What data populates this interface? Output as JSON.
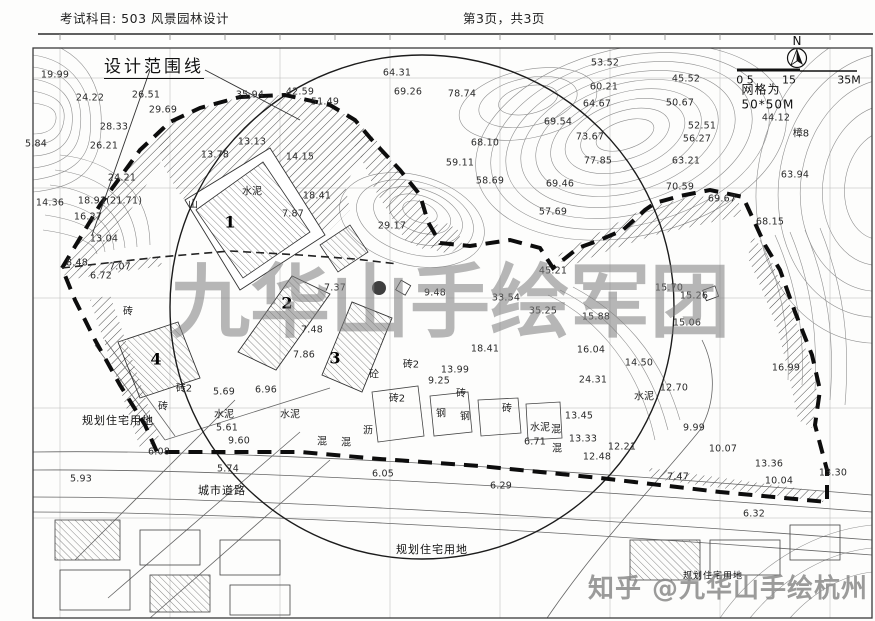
{
  "header": {
    "subject": "考试科目: 503 风景园林设计",
    "page_info": "第3页，共3页"
  },
  "map": {
    "boundary_label": "设计范围线",
    "compass": {
      "label": "N"
    },
    "scale": {
      "tick_left": "0 5",
      "tick_mid": "15",
      "tick_right": "35M",
      "grid_note": "网格为50*50M"
    },
    "building_numbers": [
      {
        "t": "1",
        "x": 230,
        "y": 222
      },
      {
        "t": "2",
        "x": 287,
        "y": 303
      },
      {
        "t": "3",
        "x": 335,
        "y": 358
      },
      {
        "t": "4",
        "x": 156,
        "y": 359
      }
    ],
    "zone_labels": [
      {
        "t": "规划住宅用地",
        "x": 118,
        "y": 420
      },
      {
        "t": "规划住宅用地",
        "x": 432,
        "y": 549
      },
      {
        "t": "规划住宅用地",
        "x": 713,
        "y": 575,
        "fs": 9
      },
      {
        "t": "城市道路",
        "x": 222,
        "y": 490
      }
    ],
    "material_labels": [
      {
        "t": "水泥",
        "x": 252,
        "y": 190
      },
      {
        "t": "山",
        "x": 193,
        "y": 203
      },
      {
        "t": "水泥",
        "x": 224,
        "y": 413
      },
      {
        "t": "水泥",
        "x": 290,
        "y": 413
      },
      {
        "t": "水泥",
        "x": 540,
        "y": 426
      },
      {
        "t": "水泥",
        "x": 644,
        "y": 395
      },
      {
        "t": "砖",
        "x": 128,
        "y": 310
      },
      {
        "t": "砖2",
        "x": 184,
        "y": 387
      },
      {
        "t": "砖",
        "x": 163,
        "y": 405
      },
      {
        "t": "砖2",
        "x": 411,
        "y": 363
      },
      {
        "t": "砖2",
        "x": 397,
        "y": 397
      },
      {
        "t": "砖",
        "x": 461,
        "y": 392
      },
      {
        "t": "砖",
        "x": 507,
        "y": 407
      },
      {
        "t": "砼",
        "x": 374,
        "y": 373
      },
      {
        "t": "钢",
        "x": 441,
        "y": 412
      },
      {
        "t": "钢",
        "x": 465,
        "y": 415
      },
      {
        "t": "混",
        "x": 556,
        "y": 428
      },
      {
        "t": "混",
        "x": 557,
        "y": 447
      },
      {
        "t": "混",
        "x": 322,
        "y": 440
      },
      {
        "t": "混",
        "x": 346,
        "y": 441
      },
      {
        "t": "沥",
        "x": 368,
        "y": 429
      },
      {
        "t": "樟8",
        "x": 801,
        "y": 132
      }
    ],
    "elevations": [
      {
        "t": "19.99",
        "x": 55,
        "y": 75
      },
      {
        "t": "24.22",
        "x": 90,
        "y": 98
      },
      {
        "t": "26.51",
        "x": 146,
        "y": 95
      },
      {
        "t": "28.33",
        "x": 114,
        "y": 127
      },
      {
        "t": "29.69",
        "x": 163,
        "y": 110
      },
      {
        "t": "26.21",
        "x": 104,
        "y": 146
      },
      {
        "t": "35.94",
        "x": 250,
        "y": 95
      },
      {
        "t": "5.84",
        "x": 36,
        "y": 144
      },
      {
        "t": "24.21",
        "x": 122,
        "y": 178
      },
      {
        "t": "18.91(21.71)",
        "x": 110,
        "y": 201
      },
      {
        "t": "14.36",
        "x": 50,
        "y": 203
      },
      {
        "t": "16.27",
        "x": 88,
        "y": 217
      },
      {
        "t": "13.04",
        "x": 104,
        "y": 239
      },
      {
        "t": "8.48",
        "x": 77,
        "y": 263
      },
      {
        "t": "7.07",
        "x": 120,
        "y": 267
      },
      {
        "t": "6.72",
        "x": 101,
        "y": 276
      },
      {
        "t": "13.78",
        "x": 215,
        "y": 155
      },
      {
        "t": "13.13",
        "x": 252,
        "y": 142
      },
      {
        "t": "14.15",
        "x": 300,
        "y": 157
      },
      {
        "t": "18.41",
        "x": 317,
        "y": 196
      },
      {
        "t": "7.87",
        "x": 293,
        "y": 214
      },
      {
        "t": "29.17",
        "x": 392,
        "y": 226
      },
      {
        "t": "42.59",
        "x": 300,
        "y": 92
      },
      {
        "t": "51.49",
        "x": 325,
        "y": 102
      },
      {
        "t": "64.31",
        "x": 397,
        "y": 73
      },
      {
        "t": "69.26",
        "x": 408,
        "y": 92
      },
      {
        "t": "78.74",
        "x": 462,
        "y": 94
      },
      {
        "t": "68.10",
        "x": 485,
        "y": 143
      },
      {
        "t": "59.11",
        "x": 460,
        "y": 163
      },
      {
        "t": "58.69",
        "x": 490,
        "y": 181
      },
      {
        "t": "53.52",
        "x": 605,
        "y": 63
      },
      {
        "t": "60.21",
        "x": 604,
        "y": 87
      },
      {
        "t": "64.67",
        "x": 597,
        "y": 104
      },
      {
        "t": "69.54",
        "x": 558,
        "y": 122
      },
      {
        "t": "73.67",
        "x": 590,
        "y": 137
      },
      {
        "t": "77.85",
        "x": 598,
        "y": 161
      },
      {
        "t": "69.46",
        "x": 560,
        "y": 184
      },
      {
        "t": "45.52",
        "x": 686,
        "y": 79
      },
      {
        "t": "50.67",
        "x": 680,
        "y": 103
      },
      {
        "t": "52.51",
        "x": 702,
        "y": 126
      },
      {
        "t": "56.27",
        "x": 697,
        "y": 139
      },
      {
        "t": "63.21",
        "x": 686,
        "y": 161
      },
      {
        "t": "70.59",
        "x": 680,
        "y": 187
      },
      {
        "t": "69.67",
        "x": 722,
        "y": 199
      },
      {
        "t": "44.12",
        "x": 776,
        "y": 118
      },
      {
        "t": "63.94",
        "x": 795,
        "y": 175
      },
      {
        "t": "68.15",
        "x": 770,
        "y": 222
      },
      {
        "t": "57.69",
        "x": 553,
        "y": 212
      },
      {
        "t": "45.21",
        "x": 553,
        "y": 271
      },
      {
        "t": "15.70",
        "x": 669,
        "y": 288
      },
      {
        "t": "15.26",
        "x": 694,
        "y": 296
      },
      {
        "t": "15.06",
        "x": 687,
        "y": 323
      },
      {
        "t": "33.54",
        "x": 506,
        "y": 298
      },
      {
        "t": "35.25",
        "x": 543,
        "y": 311
      },
      {
        "t": "15.88",
        "x": 596,
        "y": 317
      },
      {
        "t": "16.04",
        "x": 591,
        "y": 350
      },
      {
        "t": "24.31",
        "x": 593,
        "y": 380
      },
      {
        "t": "7.37",
        "x": 335,
        "y": 288
      },
      {
        "t": "9.48",
        "x": 435,
        "y": 293
      },
      {
        "t": "7.48",
        "x": 312,
        "y": 330
      },
      {
        "t": "7.86",
        "x": 304,
        "y": 355
      },
      {
        "t": "13.99",
        "x": 455,
        "y": 370
      },
      {
        "t": "9.25",
        "x": 439,
        "y": 381
      },
      {
        "t": "18.41",
        "x": 485,
        "y": 349
      },
      {
        "t": "5.69",
        "x": 224,
        "y": 392
      },
      {
        "t": "6.96",
        "x": 266,
        "y": 390
      },
      {
        "t": "5.61",
        "x": 227,
        "y": 428
      },
      {
        "t": "9.60",
        "x": 239,
        "y": 441
      },
      {
        "t": "6.08",
        "x": 159,
        "y": 452
      },
      {
        "t": "5.74",
        "x": 228,
        "y": 469
      },
      {
        "t": "5.93",
        "x": 81,
        "y": 479
      },
      {
        "t": "6.05",
        "x": 383,
        "y": 474
      },
      {
        "t": "6.29",
        "x": 501,
        "y": 486
      },
      {
        "t": "14.50",
        "x": 639,
        "y": 363
      },
      {
        "t": "12.70",
        "x": 674,
        "y": 388
      },
      {
        "t": "16.99",
        "x": 786,
        "y": 368
      },
      {
        "t": "13.45",
        "x": 579,
        "y": 416
      },
      {
        "t": "13.33",
        "x": 583,
        "y": 439
      },
      {
        "t": "12.21",
        "x": 622,
        "y": 447
      },
      {
        "t": "12.48",
        "x": 597,
        "y": 457
      },
      {
        "t": "9.99",
        "x": 694,
        "y": 428
      },
      {
        "t": "7.47",
        "x": 678,
        "y": 477
      },
      {
        "t": "10.07",
        "x": 723,
        "y": 449
      },
      {
        "t": "13.36",
        "x": 769,
        "y": 464
      },
      {
        "t": "13.30",
        "x": 833,
        "y": 473
      },
      {
        "t": "10.04",
        "x": 779,
        "y": 481
      },
      {
        "t": "6.32",
        "x": 754,
        "y": 514
      },
      {
        "t": "6.71",
        "x": 535,
        "y": 442
      }
    ]
  },
  "watermarks": {
    "center": "九华山手绘军团",
    "bottom": "知乎 @九华山手绘杭州"
  }
}
